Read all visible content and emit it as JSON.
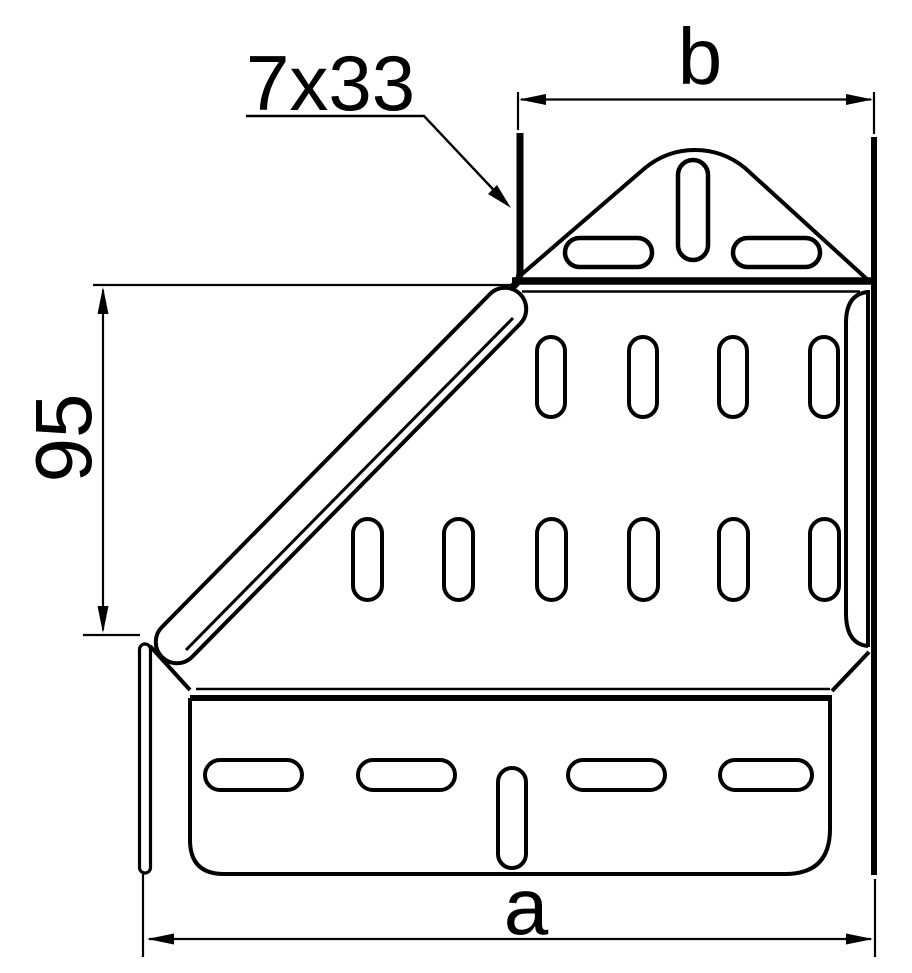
{
  "drawing": {
    "type": "technical-dimension-drawing",
    "subject": "perforated cable tray left reducer, flattened pattern view",
    "labels": {
      "holes_callout": "7x33",
      "dim_top_width": "b",
      "dim_left_height": "95",
      "dim_bottom_width": "a"
    },
    "colors": {
      "line": "#000000",
      "background": "#ffffff"
    }
  }
}
